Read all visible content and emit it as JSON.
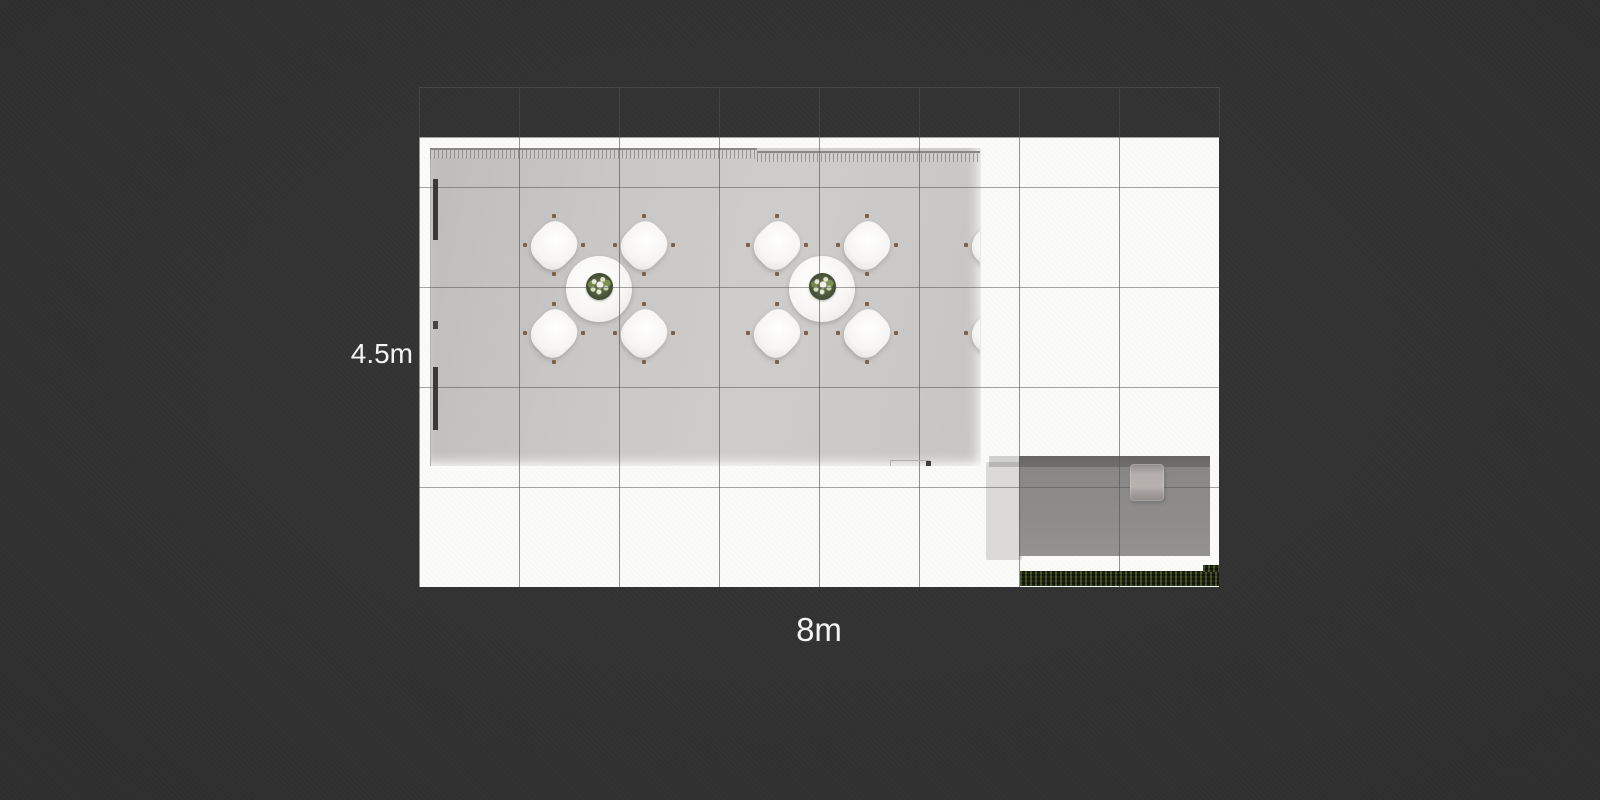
{
  "scene": {
    "description": "top-view 3D render of an exhibition/cafe room floor plan",
    "background_color": "#2e2e2e",
    "plan_sheet_color": "#fbfbfa",
    "floor_color": "#c8c6c4"
  },
  "dimensions": {
    "width_label": "8m",
    "height_label": "4.5m"
  },
  "grid": {
    "columns": 8,
    "rows": 4.5,
    "cell_meters": 1,
    "line_color_on_plan": "#8c8c8c",
    "line_color_on_dark": "#424242"
  },
  "furniture": {
    "dining_sets": {
      "count": 3,
      "chairs_per_table": 4,
      "table_shape": "round",
      "table_color": "#f3f2f0",
      "chair_color": "#f2f1ef",
      "knob_color": "#7e6149",
      "centerpiece": "green-floral-arrangement",
      "centers_px": [
        {
          "x": 169,
          "y": 141
        },
        {
          "x": 392,
          "y": 141
        },
        {
          "x": 610,
          "y": 141
        }
      ],
      "chair_offsets_px": [
        {
          "x": -45,
          "y": -44
        },
        {
          "x": 45,
          "y": -44
        },
        {
          "x": -45,
          "y": 44
        },
        {
          "x": 45,
          "y": 44
        }
      ]
    },
    "desk": {
      "color": "#8b8987",
      "side_panel_color": "#dbdad8",
      "cabinet_color": "#b4afac"
    },
    "hedge": {
      "color": "#202415"
    }
  }
}
